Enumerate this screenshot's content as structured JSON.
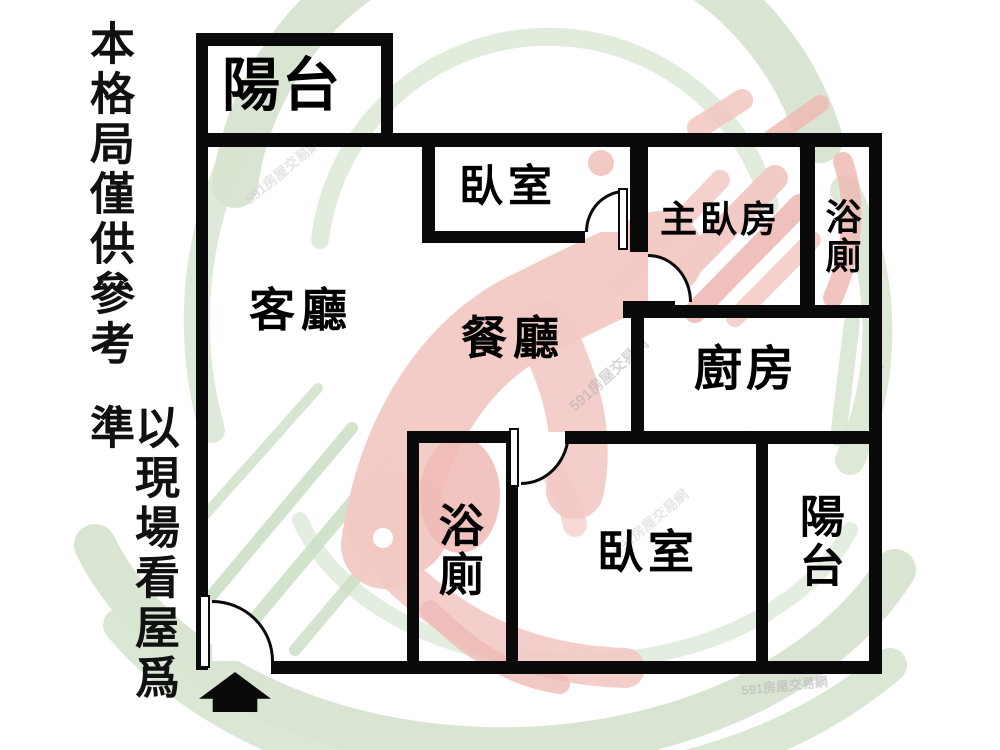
{
  "title": "apartment-floor-plan",
  "disclaimer": {
    "line1": "本格局僅供參考",
    "line2": "以現場看屋爲準"
  },
  "rooms": {
    "balcony_top": {
      "label": "陽台"
    },
    "bedroom_top": {
      "label": "臥室"
    },
    "master_bedroom": {
      "label": "主臥房"
    },
    "bath_top": {
      "label": "浴廁"
    },
    "living": {
      "label": "客廳"
    },
    "dining": {
      "label": "餐廳"
    },
    "kitchen": {
      "label": "廚房"
    },
    "bath_bottom": {
      "label": "浴廁"
    },
    "bedroom_bottom": {
      "label": "臥室"
    },
    "balcony_bottom": {
      "label": "陽台"
    }
  },
  "entrance": {
    "symbol": "up-arrow"
  },
  "watermark": {
    "brand": "591",
    "text": "591房屋交易網",
    "colors": {
      "green": "#d7e4d0",
      "green2": "#cde0c6",
      "pink": "#f3c9c4",
      "pink2": "#efbab5"
    }
  }
}
